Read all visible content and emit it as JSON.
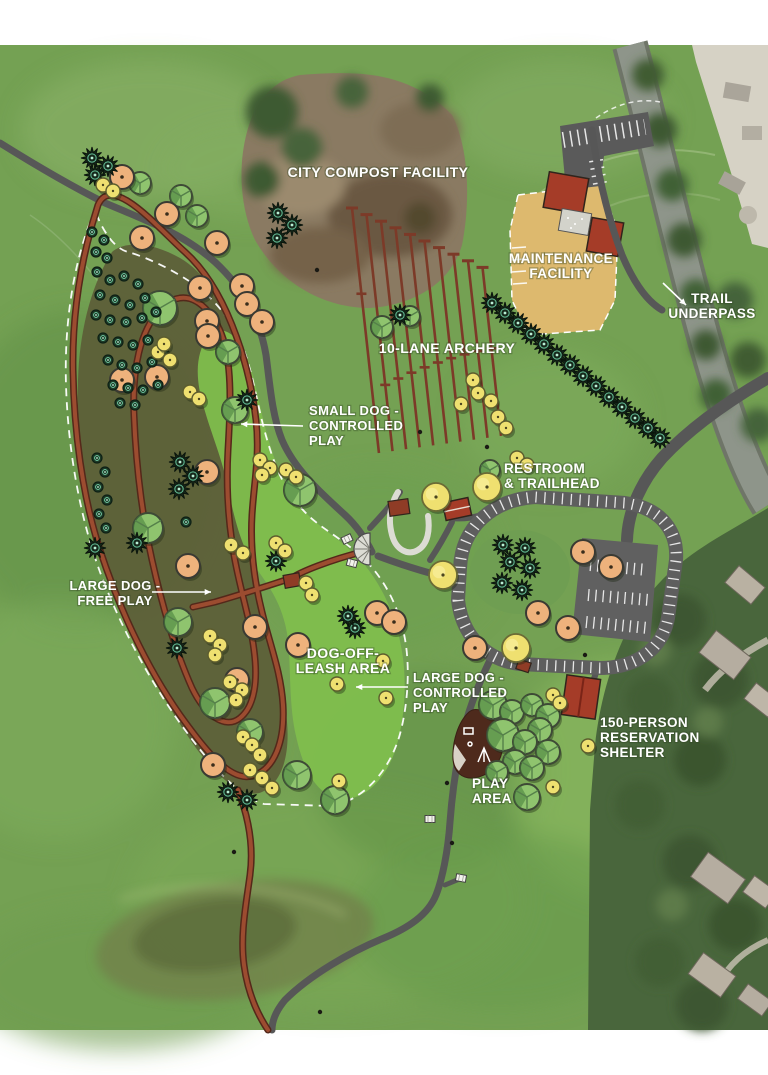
{
  "page": {
    "title": "Park master plan – aerial site map",
    "type": "site-plan-overlay-on-aerial-photo"
  },
  "colors": {
    "page_margin": "#ffffff",
    "grass_base": "#74a153",
    "off_leash_green": "#7fbe4d",
    "large_dog_olive": "#5c5f38",
    "trail_red": "#9c4c30",
    "trail_gray": "#575757",
    "road_gray": "#5e5e5e",
    "building_red": "#a53c28",
    "maintenance_tan": "#ddb96e",
    "compost_brown": "#8a7a62",
    "label_text": "#ffffff"
  },
  "labels": [
    {
      "id": "compost",
      "lines": [
        "CITY COMPOST FACILITY"
      ],
      "x": 378,
      "y": 177,
      "anchor": "middle",
      "size": 14
    },
    {
      "id": "maintenance",
      "lines": [
        "MAINTENANCE",
        "FACILITY"
      ],
      "x": 561,
      "y": 263,
      "anchor": "middle",
      "size": 13.5
    },
    {
      "id": "trail-underpass",
      "lines": [
        "TRAIL",
        "UNDERPASS"
      ],
      "x": 712,
      "y": 303,
      "anchor": "middle",
      "size": 13.5
    },
    {
      "id": "archery",
      "lines": [
        "10-LANE ARCHERY"
      ],
      "x": 447,
      "y": 353,
      "anchor": "middle",
      "size": 14
    },
    {
      "id": "small-dog",
      "lines": [
        "SMALL DOG -",
        "CONTROLLED",
        "PLAY"
      ],
      "x": 309,
      "y": 415,
      "anchor": "start",
      "size": 13
    },
    {
      "id": "restroom",
      "lines": [
        "RESTROOM",
        "& TRAILHEAD"
      ],
      "x": 504,
      "y": 473,
      "anchor": "start",
      "size": 13.5
    },
    {
      "id": "large-dog-free",
      "lines": [
        "LARGE DOG -",
        "FREE PLAY"
      ],
      "x": 115,
      "y": 590,
      "anchor": "middle",
      "size": 13
    },
    {
      "id": "dog-off-leash",
      "lines": [
        "DOG-OFF-",
        "LEASH AREA"
      ],
      "x": 343,
      "y": 658,
      "anchor": "middle",
      "size": 14
    },
    {
      "id": "large-dog-controlled",
      "lines": [
        "LARGE DOG -",
        "CONTROLLED",
        "PLAY"
      ],
      "x": 413,
      "y": 682,
      "anchor": "start",
      "size": 13
    },
    {
      "id": "shelter",
      "lines": [
        "150-PERSON",
        "RESERVATION",
        "SHELTER"
      ],
      "x": 600,
      "y": 727,
      "anchor": "start",
      "size": 13.5
    },
    {
      "id": "play-area",
      "lines": [
        "PLAY",
        "AREA"
      ],
      "x": 472,
      "y": 788,
      "anchor": "start",
      "size": 13.5
    }
  ],
  "arrows": [
    {
      "id": "small-dog-arrow",
      "x1": 303,
      "y1": 426,
      "x2": 241,
      "y2": 424
    },
    {
      "id": "free-play-arrow",
      "x1": 152,
      "y1": 592,
      "x2": 211,
      "y2": 592
    },
    {
      "id": "controlled-play-arrow",
      "x1": 408,
      "y1": 687,
      "x2": 356,
      "y2": 687
    },
    {
      "id": "underpass-arrow",
      "x1": 663,
      "y1": 283,
      "x2": 686,
      "y2": 305
    }
  ],
  "areas": [
    {
      "id": "large-dog-free-play-area",
      "name": "LARGE DOG - FREE PLAY"
    },
    {
      "id": "dog-off-leash-area",
      "name": "DOG-OFF-LEASH AREA"
    },
    {
      "id": "small-dog-controlled-play-area",
      "name": "SMALL DOG - CONTROLLED PLAY"
    },
    {
      "id": "large-dog-controlled-play-area",
      "name": "LARGE DOG - CONTROLLED PLAY"
    }
  ],
  "archery": {
    "lanes": 10,
    "top_x": 352,
    "top_y": 208,
    "step_x": 14.5,
    "step_y": 6.6,
    "base_len": 245,
    "len_step": -8.5
  },
  "trees": {
    "orange": [
      [
        122,
        177
      ],
      [
        167,
        214
      ],
      [
        142,
        238
      ],
      [
        217,
        243
      ],
      [
        200,
        288
      ],
      [
        242,
        286
      ],
      [
        247,
        304
      ],
      [
        262,
        322
      ],
      [
        207,
        321
      ],
      [
        208,
        336
      ],
      [
        122,
        380
      ],
      [
        157,
        377
      ],
      [
        207,
        472
      ],
      [
        188,
        566
      ],
      [
        255,
        627
      ],
      [
        298,
        645
      ],
      [
        377,
        613
      ],
      [
        394,
        622
      ],
      [
        237,
        680
      ],
      [
        213,
        765
      ],
      [
        538,
        613
      ],
      [
        568,
        628
      ],
      [
        475,
        648
      ],
      [
        583,
        552
      ],
      [
        611,
        567
      ]
    ],
    "yellow": [
      [
        103,
        185
      ],
      [
        113,
        191
      ],
      [
        158,
        352
      ],
      [
        170,
        360
      ],
      [
        164,
        344
      ],
      [
        190,
        392
      ],
      [
        199,
        399
      ],
      [
        260,
        460
      ],
      [
        270,
        468
      ],
      [
        262,
        475
      ],
      [
        286,
        470
      ],
      [
        296,
        477
      ],
      [
        231,
        545
      ],
      [
        243,
        553
      ],
      [
        276,
        543
      ],
      [
        285,
        551
      ],
      [
        306,
        583
      ],
      [
        312,
        595
      ],
      [
        210,
        636
      ],
      [
        220,
        645
      ],
      [
        215,
        655
      ],
      [
        230,
        682
      ],
      [
        242,
        690
      ],
      [
        236,
        700
      ],
      [
        243,
        737
      ],
      [
        252,
        745
      ],
      [
        260,
        755
      ],
      [
        250,
        770
      ],
      [
        262,
        778
      ],
      [
        272,
        788
      ],
      [
        337,
        684
      ],
      [
        383,
        661
      ],
      [
        386,
        698
      ],
      [
        339,
        781
      ],
      [
        553,
        695
      ],
      [
        560,
        703
      ],
      [
        588,
        746
      ],
      [
        553,
        787
      ],
      [
        473,
        380
      ],
      [
        478,
        393
      ],
      [
        491,
        401
      ],
      [
        498,
        417
      ],
      [
        506,
        428
      ],
      [
        461,
        404
      ],
      [
        517,
        458
      ],
      [
        527,
        465
      ]
    ],
    "yellow_big": [
      [
        487,
        487
      ],
      [
        436,
        497
      ],
      [
        443,
        575
      ],
      [
        516,
        648
      ]
    ],
    "green": [
      [
        140,
        183,
        11
      ],
      [
        181,
        196,
        11
      ],
      [
        197,
        216,
        11
      ],
      [
        160,
        308,
        17
      ],
      [
        228,
        352,
        12
      ],
      [
        235,
        410,
        13
      ],
      [
        300,
        490,
        16
      ],
      [
        148,
        528,
        15
      ],
      [
        178,
        622,
        14
      ],
      [
        215,
        703,
        15
      ],
      [
        250,
        732,
        13
      ],
      [
        297,
        775,
        14
      ],
      [
        335,
        800,
        14
      ],
      [
        382,
        327,
        11
      ],
      [
        410,
        316,
        10
      ],
      [
        490,
        470,
        10
      ],
      [
        493,
        705,
        14
      ],
      [
        512,
        712,
        12
      ],
      [
        532,
        705,
        11
      ],
      [
        548,
        716,
        12
      ],
      [
        540,
        730,
        12
      ],
      [
        503,
        735,
        16
      ],
      [
        525,
        742,
        12
      ],
      [
        548,
        752,
        12
      ],
      [
        515,
        762,
        12
      ],
      [
        532,
        768,
        12
      ],
      [
        497,
        772,
        11
      ],
      [
        527,
        797,
        13
      ]
    ],
    "evergreen": [
      [
        492,
        303
      ],
      [
        505,
        313
      ],
      [
        518,
        323
      ],
      [
        531,
        334
      ],
      [
        544,
        344
      ],
      [
        557,
        355
      ],
      [
        570,
        365
      ],
      [
        583,
        376
      ],
      [
        596,
        386
      ],
      [
        609,
        397
      ],
      [
        622,
        407
      ],
      [
        635,
        418
      ],
      [
        648,
        428
      ],
      [
        660,
        438
      ],
      [
        92,
        158
      ],
      [
        108,
        166
      ],
      [
        95,
        175
      ],
      [
        278,
        213
      ],
      [
        292,
        225
      ],
      [
        277,
        238
      ],
      [
        400,
        315
      ],
      [
        276,
        561
      ],
      [
        177,
        648
      ],
      [
        355,
        628
      ],
      [
        348,
        616
      ],
      [
        503,
        545
      ],
      [
        525,
        548
      ],
      [
        510,
        562
      ],
      [
        530,
        568
      ],
      [
        502,
        583
      ],
      [
        522,
        590
      ],
      [
        228,
        792
      ],
      [
        247,
        800
      ],
      [
        180,
        462
      ],
      [
        193,
        476
      ],
      [
        179,
        489
      ],
      [
        247,
        400
      ],
      [
        137,
        543
      ],
      [
        95,
        548
      ]
    ],
    "shrub": [
      [
        97,
        272
      ],
      [
        110,
        280
      ],
      [
        124,
        276
      ],
      [
        138,
        284
      ],
      [
        100,
        295
      ],
      [
        115,
        300
      ],
      [
        130,
        305
      ],
      [
        145,
        298
      ],
      [
        96,
        315
      ],
      [
        110,
        320
      ],
      [
        126,
        322
      ],
      [
        142,
        318
      ],
      [
        156,
        312
      ],
      [
        103,
        338
      ],
      [
        118,
        342
      ],
      [
        133,
        345
      ],
      [
        148,
        340
      ],
      [
        108,
        360
      ],
      [
        122,
        365
      ],
      [
        137,
        368
      ],
      [
        152,
        362
      ],
      [
        165,
        355
      ],
      [
        113,
        385
      ],
      [
        128,
        388
      ],
      [
        143,
        390
      ],
      [
        158,
        385
      ],
      [
        120,
        403
      ],
      [
        135,
        405
      ],
      [
        97,
        458
      ],
      [
        105,
        472
      ],
      [
        98,
        487
      ],
      [
        107,
        500
      ],
      [
        99,
        514
      ],
      [
        106,
        528
      ],
      [
        186,
        522
      ],
      [
        92,
        232
      ],
      [
        104,
        240
      ],
      [
        96,
        252
      ],
      [
        107,
        258
      ]
    ]
  },
  "benches": [
    [
      347,
      539,
      -25
    ],
    [
      352,
      563,
      15
    ],
    [
      430,
      819,
      0
    ],
    [
      461,
      878,
      10
    ]
  ],
  "dots": [
    [
      317,
      270
    ],
    [
      420,
      432
    ],
    [
      487,
      447
    ],
    [
      585,
      655
    ],
    [
      447,
      783
    ],
    [
      452,
      843
    ],
    [
      234,
      852
    ],
    [
      320,
      1012
    ]
  ]
}
